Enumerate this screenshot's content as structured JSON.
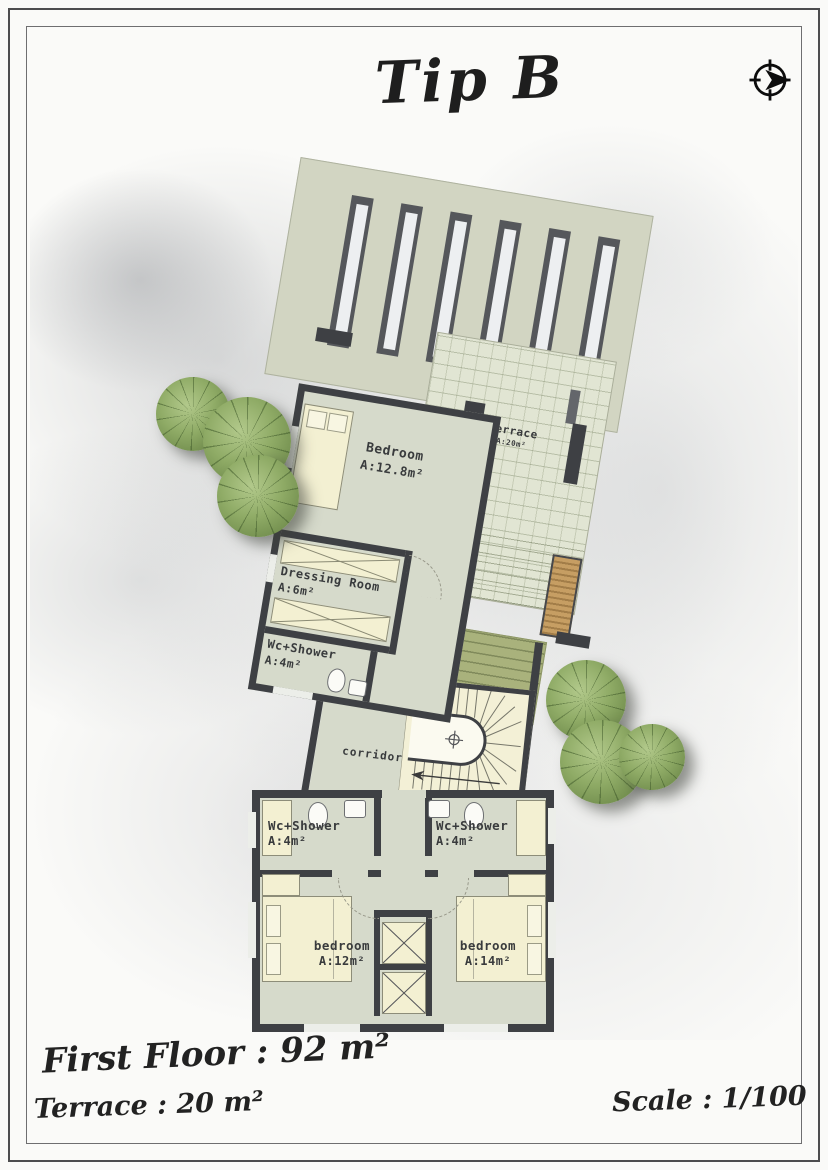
{
  "sheet": {
    "title": "Tip B",
    "footer": {
      "first_floor": "First Floor : 92 m²",
      "terrace": "Terrace : 20 m²",
      "scale": "Scale : 1/100"
    }
  },
  "plan": {
    "rooms": {
      "bedroom_master": {
        "name": "Bedroom",
        "area": "A:12.8m²"
      },
      "dressing_room": {
        "name": "Dressing Room",
        "area": "A:6m²"
      },
      "wc_shower_upper": {
        "name": "Wc+Shower",
        "area": "A:4m²"
      },
      "terrace": {
        "name": "Terrace",
        "area": "A:20m²"
      },
      "corridor": {
        "name": "corridor"
      },
      "wc_shower_left": {
        "name": "Wc+Shower",
        "area": "A:4m²"
      },
      "wc_shower_right": {
        "name": "Wc+Shower",
        "area": "A:4m²"
      },
      "bedroom_left": {
        "name": "bedroom",
        "area": "A:12m²"
      },
      "bedroom_right": {
        "name": "bedroom",
        "area": "A:14m²"
      }
    },
    "icons": {
      "north_arrow": "north-arrow-icon"
    },
    "colors": {
      "wall": "#3e4044",
      "slab": "#d2d5c2",
      "floor": "#d6dacb",
      "terrace_tile": "#e1e5d3",
      "furniture": "#f3f0d2",
      "stair": "#f3f0d6",
      "green_roof": "#a9b27c",
      "tree": "#86a35e",
      "wood": "#c69e63"
    }
  }
}
